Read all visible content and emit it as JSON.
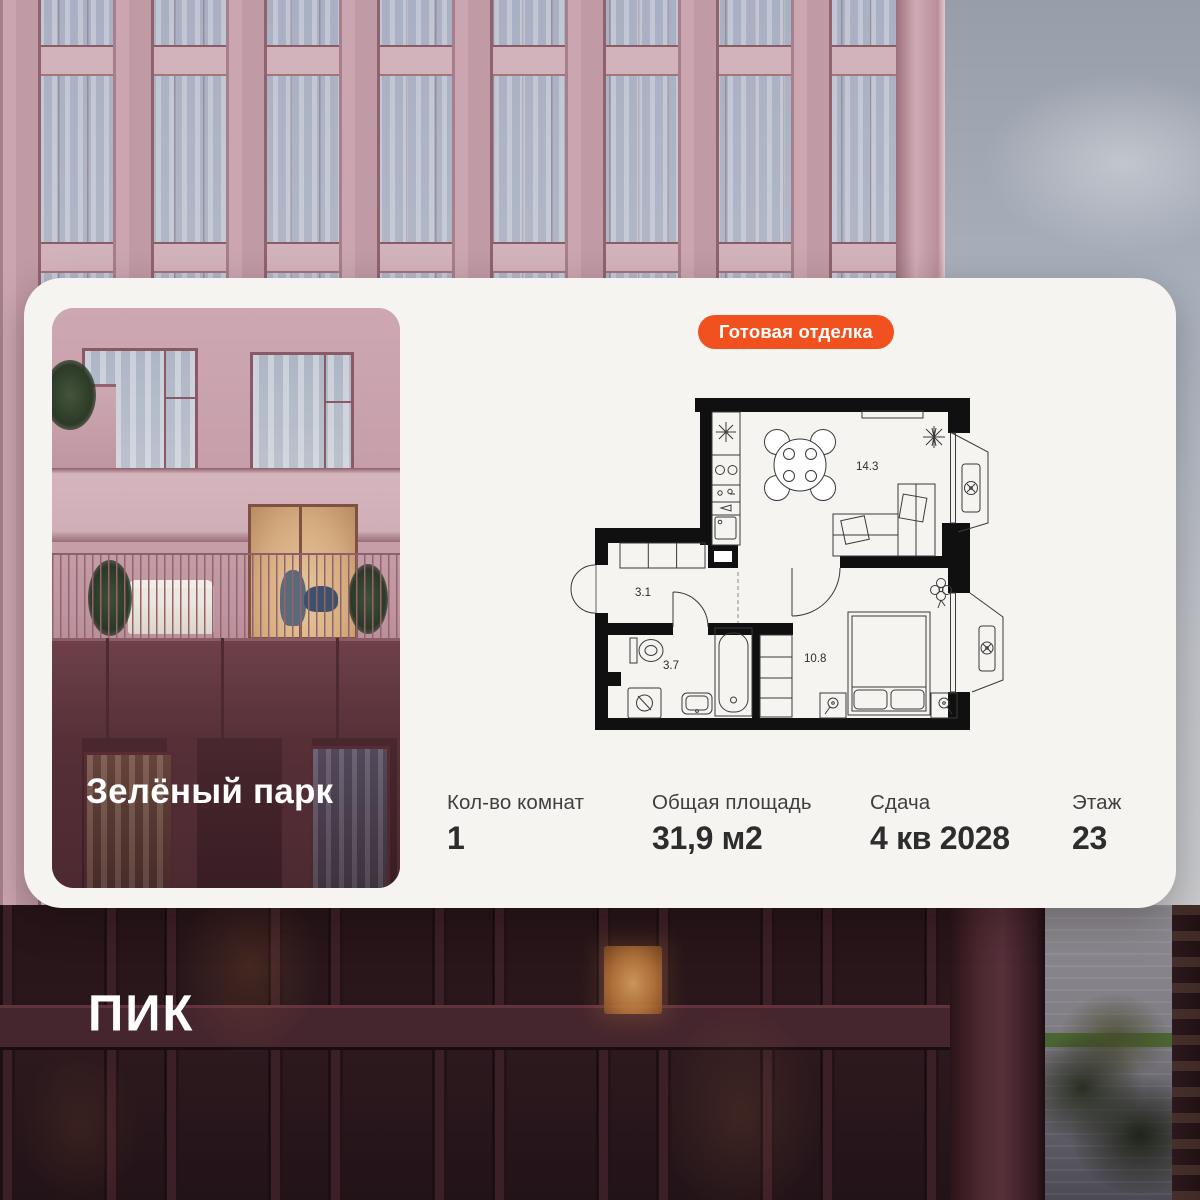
{
  "brand": {
    "logo": "ПИК"
  },
  "card": {
    "badge_label": "Готовая отделка",
    "project_name": "Зелёный парк",
    "floor_plan": {
      "rooms": {
        "kitchen_living": "14.3",
        "hallway": "3.1",
        "bathroom": "3.7",
        "bedroom": "10.8"
      }
    },
    "stats": [
      {
        "label": "Кол-во комнат",
        "value": "1"
      },
      {
        "label": "Общая площадь",
        "value": "31,9 м2"
      },
      {
        "label": "Сдача",
        "value": "4 кв 2028"
      },
      {
        "label": "Этаж",
        "value": "23"
      }
    ]
  },
  "colors": {
    "accent_orange": "#F1511E",
    "card_background": "#F5F4F1",
    "plan_walls": "#101010"
  }
}
